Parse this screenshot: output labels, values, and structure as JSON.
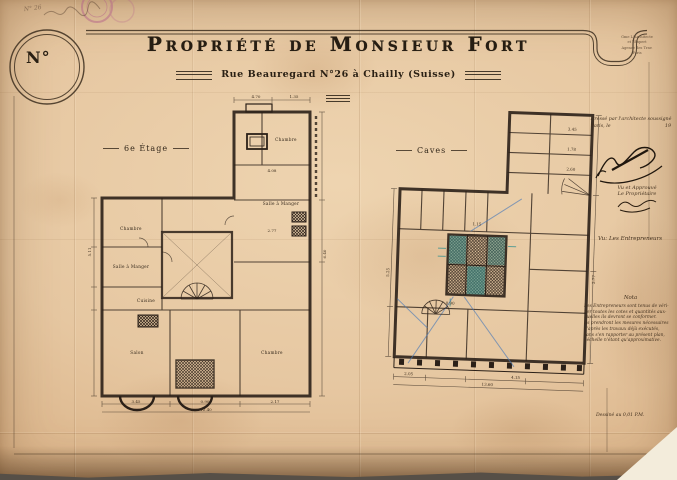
{
  "sheet": {
    "corner_number_label": "N°",
    "pencil_note": "N° 26",
    "title": "Propriété de Monsieur Fort",
    "subtitle": "Rue Beauregard N°26 à Chailly (Suisse)"
  },
  "stamp": {
    "line1": "Gme L'Architecte",
    "line2": "et l'Expert",
    "line3": "Agence des Trav.",
    "line4": "Paris"
  },
  "annotations": {
    "drafted_line1": "Dressé par l'architecte soussigné",
    "drafted_line2": "Paris, le",
    "drafted_year": "19",
    "approved_line1": "Vu et Approuvé",
    "approved_line2": "Le Propriétaire",
    "contractors_heading": "Vu: Les Entrepreneurs",
    "nota_title": "Nota",
    "nota_lines": [
      "Les Entrepreneurs sont tenus de véri-",
      "fier toutes les cotes et quantités aux-",
      "quelles ils devront se conformer.",
      "Ils prendront les mesures nécessaires",
      "d'après les travaux déjà exécutés,",
      "sans s'en rapporter au présent plan,",
      "l'échelle n'étant qu'approximative."
    ],
    "scale_note": "Dessiné au 0,01 P.M."
  },
  "plans": {
    "left": {
      "label": "6e Étage",
      "rooms": [
        "Chambre",
        "Salle à Manger",
        "Cuisine",
        "Chambre",
        "Salle à Manger",
        "Salon",
        "Chambre"
      ],
      "dims": [
        "4.08",
        "2.77",
        "5.11",
        "3.45",
        "0.90",
        "2.17",
        "6.40",
        "12.40",
        "4.70",
        "1.35"
      ]
    },
    "right": {
      "label": "Caves",
      "dims": [
        "3.45",
        "1.78",
        "2.60",
        "2.05",
        "5.25",
        "1.15",
        "2.77",
        "0.90",
        "13.60",
        "4.15"
      ]
    }
  },
  "colors": {
    "ink": "#2b2018",
    "teal": "#2f8f8f",
    "blue": "#4a7ab8",
    "stamp": "#b5638a"
  }
}
